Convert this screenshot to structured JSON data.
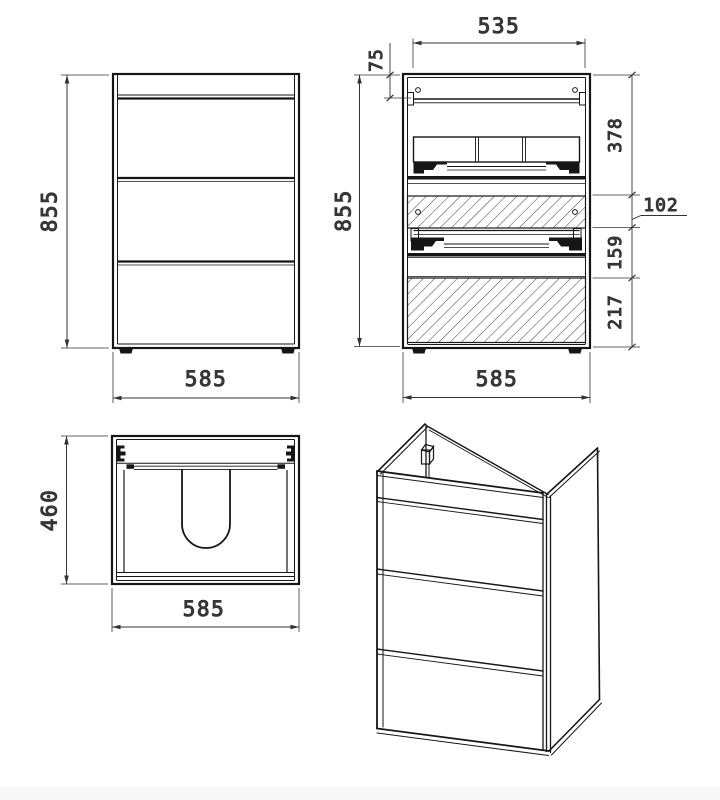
{
  "drawing": {
    "type": "furniture-technical-drawing",
    "views": {
      "front": {
        "name": "front-view",
        "height": "855",
        "width": "585"
      },
      "section": {
        "name": "section-view",
        "top_width": "535",
        "top_inset": "75",
        "height": "855",
        "seg1": "378",
        "seg2": "102",
        "seg3": "159",
        "seg4": "217",
        "width": "585"
      },
      "top": {
        "name": "top-view",
        "depth": "460",
        "width": "585"
      },
      "iso": {
        "name": "isometric-view"
      }
    },
    "colors": {
      "line": "#161616",
      "dimension_line": "#333333",
      "dimension_text": "#3a3a3a",
      "background": "#ffffff",
      "footer_strip": "#f7f7f7"
    }
  }
}
